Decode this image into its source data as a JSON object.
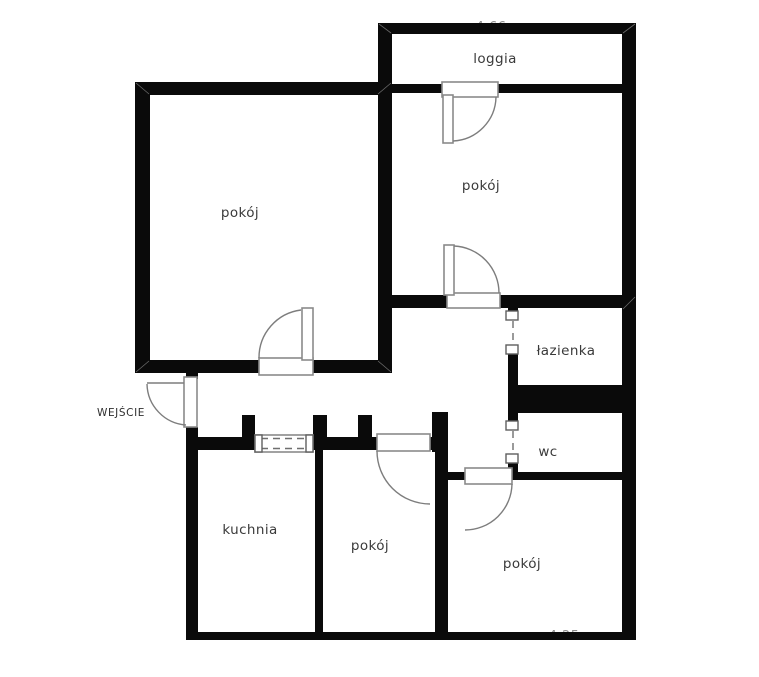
{
  "plan": {
    "type": "apartment-floor-plan",
    "background_color": "#ffffff",
    "wall_color": "#0a0a0a",
    "door_line_color": "#7d7d7d",
    "label_color": "#3a3a3a",
    "dimension_color": "#8c8c8c"
  },
  "rooms": {
    "room_top_left": {
      "label": "pokój"
    },
    "room_top_right": {
      "label": "pokój"
    },
    "loggia": {
      "label": "loggia"
    },
    "bathroom": {
      "label": "łazienka"
    },
    "toilet": {
      "label": "wc"
    },
    "kitchen": {
      "label": "kuchnia"
    },
    "room_bottom_middle": {
      "label": "pokój"
    },
    "room_bottom_right": {
      "label": "pokój"
    }
  },
  "entrance": {
    "label": "WEJŚCIE"
  },
  "dimensions": {
    "top_partial": "4.66 m",
    "bottom_partial": "4.25 m"
  }
}
